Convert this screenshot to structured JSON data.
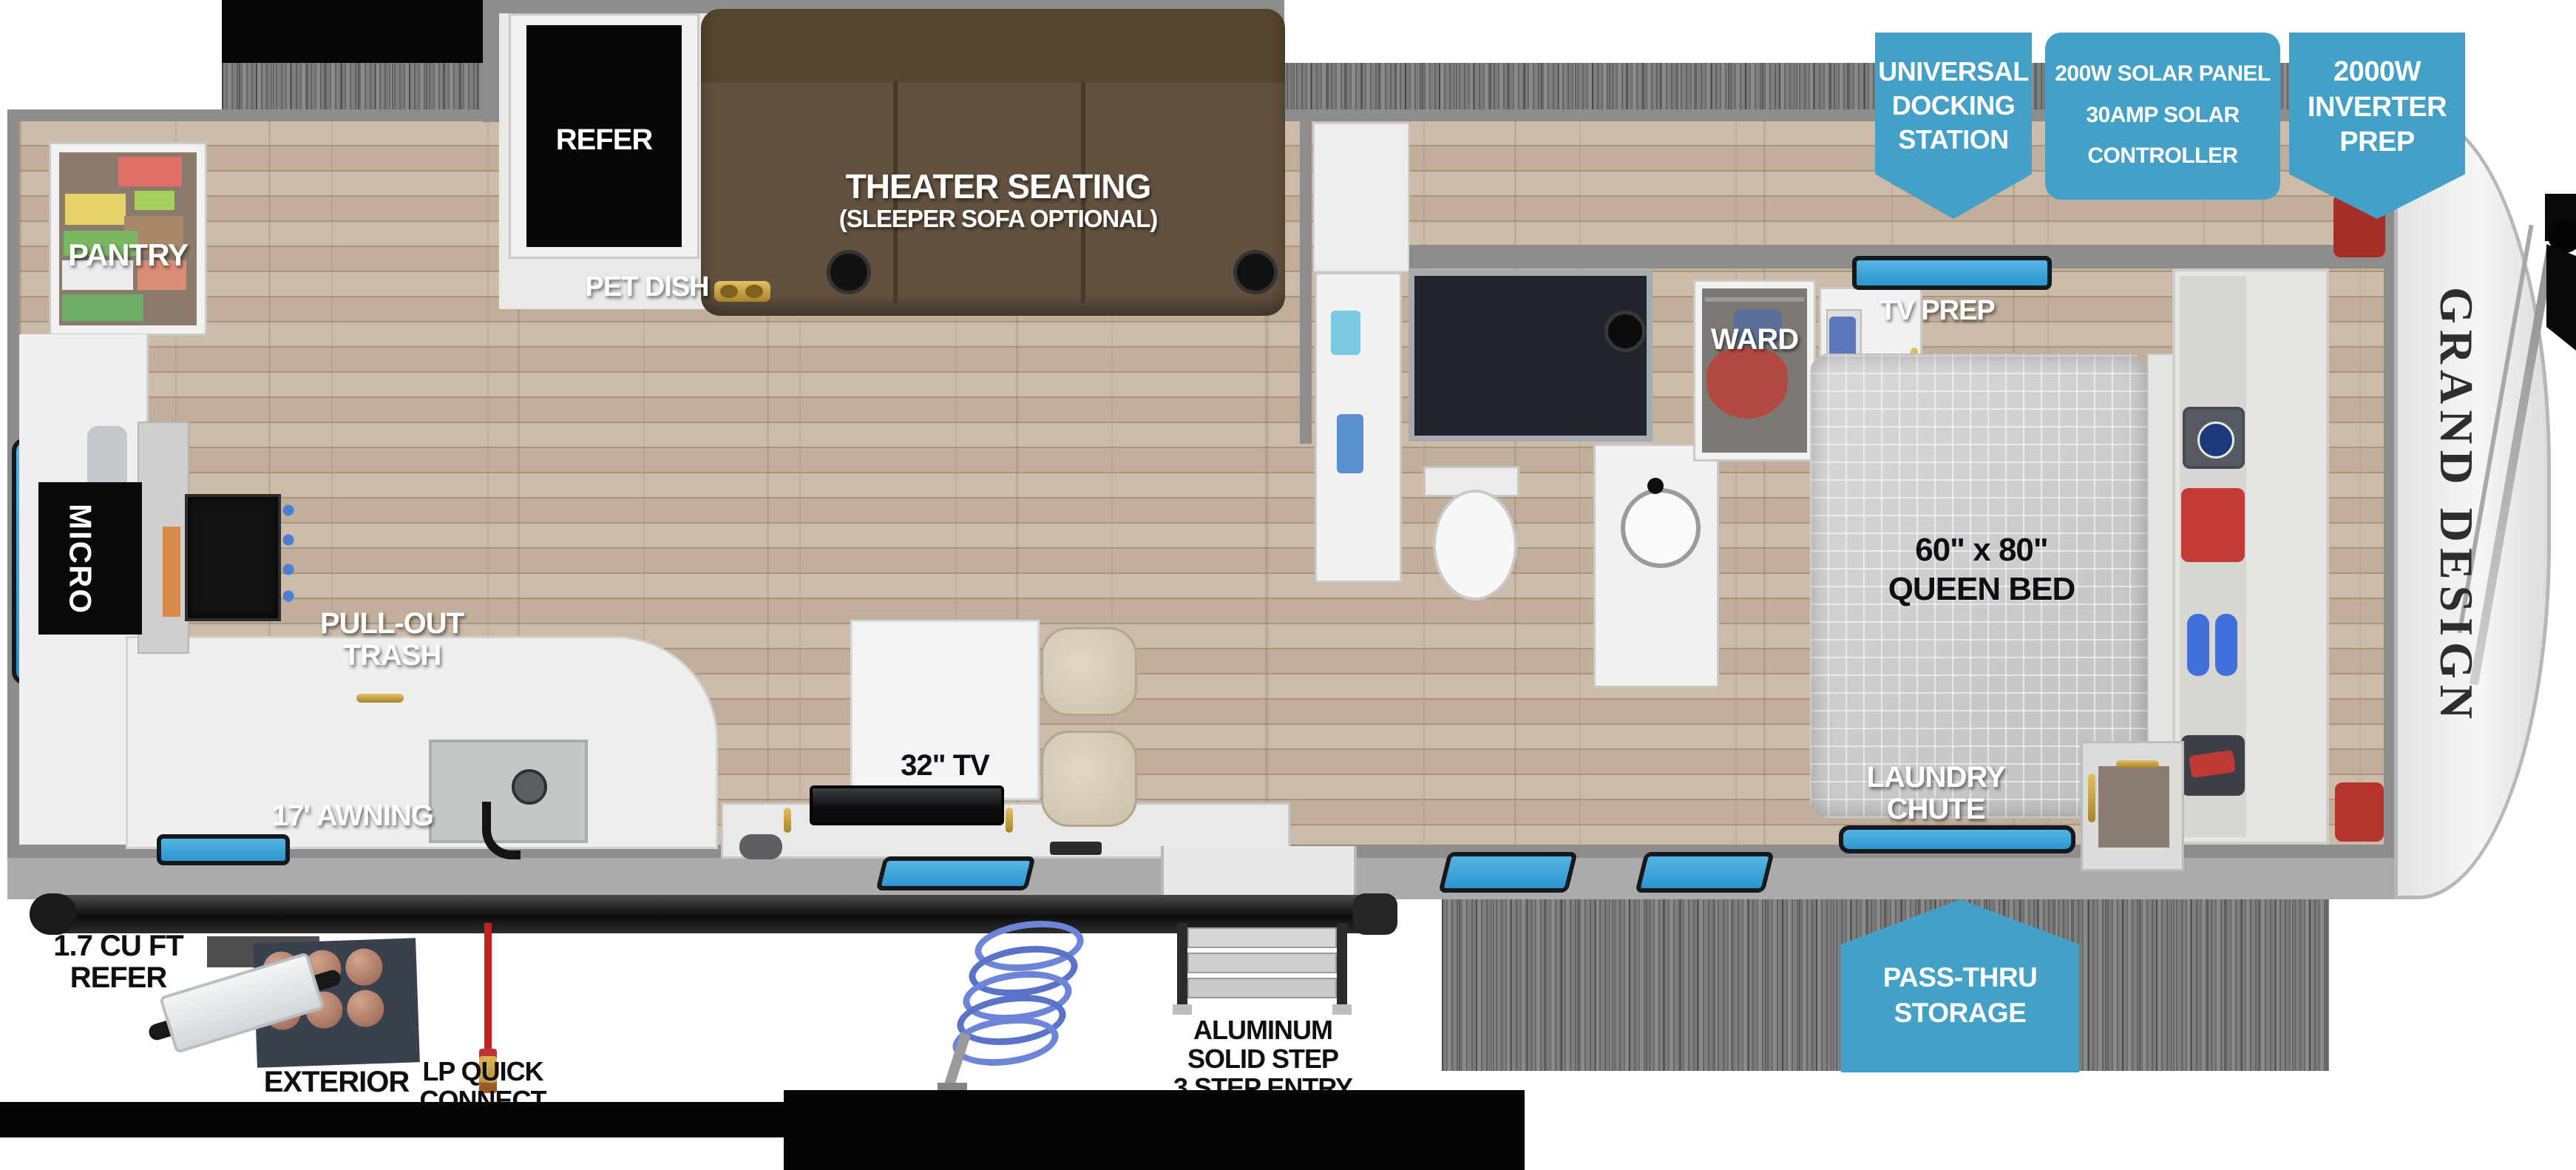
{
  "title": "Travel trailer floorplan",
  "colors": {
    "badge_blue": "#45a0c8",
    "window_blue": "#2f9fd8",
    "wall_gray": "#8d8d8d",
    "floor_tan": "#c8b7a4",
    "sofa_brown": "#63513f",
    "label_white": "#ffffff",
    "label_black": "#0f0f13"
  },
  "badges": {
    "docking": {
      "line1": "UNIVERSAL",
      "line2": "DOCKING",
      "line3": "STATION"
    },
    "solar": {
      "line1": "200W SOLAR PANEL",
      "line2": "30AMP SOLAR",
      "line3": "CONTROLLER"
    },
    "inverter": {
      "line1": "2000W",
      "line2": "INVERTER",
      "line3": "PREP"
    },
    "passthru": {
      "line1": "PASS-THRU",
      "line2": "STORAGE"
    }
  },
  "labels": {
    "refer": "REFER",
    "pantry": "PANTRY",
    "micro": "MICRO",
    "pet_dish": "PET DISH",
    "theater_line1": "THEATER SEATING",
    "theater_line2": "(SLEEPER SOFA OPTIONAL)",
    "trash_line1": "PULL-OUT",
    "trash_line2": "TRASH",
    "tv": "32\" TV",
    "ward": "WARD",
    "tv_prep": "TV PREP",
    "bed_line1": "60\" x 80\"",
    "bed_line2": "QUEEN BED",
    "laundry_line1": "LAUNDRY",
    "laundry_line2": "CHUTE",
    "awning": "17' AWNING",
    "ext_refer_line1": "1.7 CU FT",
    "ext_refer_line2": "REFER",
    "exterior": "EXTERIOR",
    "lp_line1": "LP QUICK",
    "lp_line2": "CONNECT",
    "step_line1": "ALUMINUM",
    "step_line2": "SOLID STEP",
    "step_line3": "3 STEP ENTRY"
  },
  "brand": {
    "name": "GRAND DESIGN"
  }
}
